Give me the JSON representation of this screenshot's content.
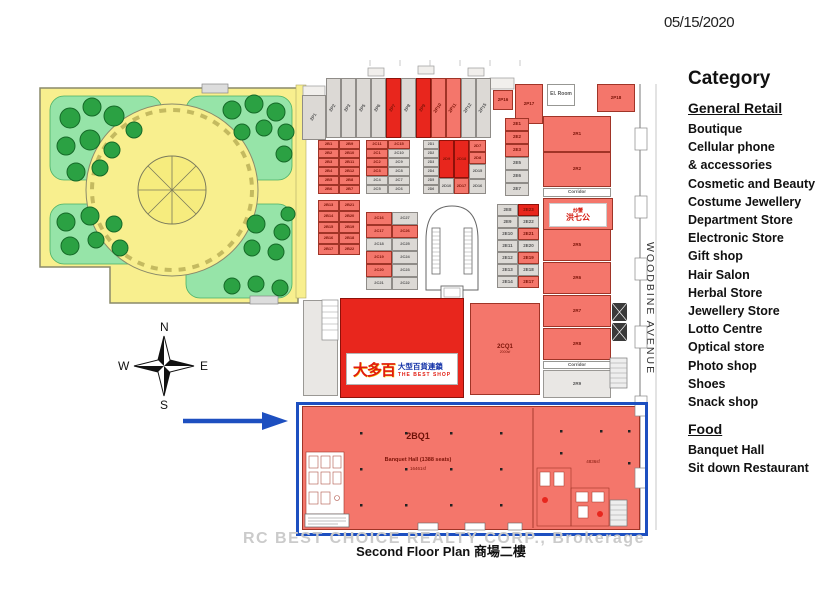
{
  "date": "05/15/2020",
  "street": "WOODBINE AVENUE",
  "caption": {
    "watermark": "RC BEST CHOICE REALTY CORP., Brokerage",
    "title": "Second Floor Plan 商場二樓"
  },
  "legend": {
    "title": "Category",
    "sections": [
      {
        "heading": "General Retail",
        "items": [
          "Boutique",
          "Cellular phone",
          "& accessories",
          "Cosmetic and Beauty",
          "Costume Jewellery",
          "Department Store",
          "Electronic Store",
          "Gift shop",
          "Hair Salon",
          "Herbal Store",
          "Jewellery Store",
          "Lotto Centre",
          "Optical store",
          "Photo shop",
          "Shoes",
          "Snack shop"
        ]
      },
      {
        "heading": "Food",
        "items": [
          "Banquet Hall",
          "Sit down Restaurant"
        ]
      }
    ]
  },
  "plan": {
    "compass": {
      "n": "N",
      "e": "E",
      "s": "S",
      "w": "W"
    },
    "banquet": {
      "label": "2BQ1",
      "desc": "Banquet Hall (1388 seats)",
      "area": "16461sf",
      "area_right": "4836sf"
    },
    "shop": {
      "main": "大多百",
      "sub_cn": "大型百貨連鎖",
      "sub_en": "THE BEST SHOP"
    },
    "restaurant": {
      "line1": "炒蟹",
      "line2": "洪七公"
    },
    "units": [
      {
        "l": "2P1",
        "c": "g",
        "x": 302,
        "y": 95,
        "w": 24,
        "h": 45,
        "rot": 1
      },
      {
        "l": "2P2",
        "c": "g",
        "x": 326,
        "y": 78,
        "w": 15,
        "h": 60,
        "rot": 1
      },
      {
        "l": "2P3",
        "c": "g",
        "x": 341,
        "y": 78,
        "w": 15,
        "h": 60,
        "rot": 1
      },
      {
        "l": "2P5",
        "c": "g",
        "x": 356,
        "y": 78,
        "w": 15,
        "h": 60,
        "rot": 1
      },
      {
        "l": "2P6",
        "c": "g",
        "x": 371,
        "y": 78,
        "w": 15,
        "h": 60,
        "rot": 1
      },
      {
        "l": "2P7",
        "c": "R",
        "x": 386,
        "y": 78,
        "w": 15,
        "h": 60,
        "rot": 1
      },
      {
        "l": "2P8",
        "c": "g",
        "x": 401,
        "y": 78,
        "w": 15,
        "h": 60,
        "rot": 1
      },
      {
        "l": "2P9",
        "c": "R",
        "x": 416,
        "y": 78,
        "w": 15,
        "h": 60,
        "rot": 1
      },
      {
        "l": "2P10",
        "c": "r",
        "x": 431,
        "y": 78,
        "w": 15,
        "h": 60,
        "rot": 1
      },
      {
        "l": "2P11",
        "c": "r",
        "x": 446,
        "y": 78,
        "w": 15,
        "h": 60,
        "rot": 1
      },
      {
        "l": "2P12",
        "c": "g",
        "x": 461,
        "y": 78,
        "w": 15,
        "h": 60,
        "rot": 1
      },
      {
        "l": "2P15",
        "c": "g",
        "x": 476,
        "y": 78,
        "w": 15,
        "h": 60,
        "rot": 1
      },
      {
        "l": "2P16",
        "c": "r",
        "x": 493,
        "y": 90,
        "w": 20,
        "h": 20
      },
      {
        "l": "2P17",
        "c": "r",
        "x": 515,
        "y": 84,
        "w": 28,
        "h": 40
      },
      {
        "l": "El. Room",
        "c": "w",
        "x": 547,
        "y": 84,
        "w": 28,
        "h": 22,
        "f": 5
      },
      {
        "l": "2P18",
        "c": "r",
        "x": 597,
        "y": 84,
        "w": 38,
        "h": 28
      },
      {
        "l": "2R1",
        "c": "r",
        "x": 543,
        "y": 116,
        "w": 68,
        "h": 36
      },
      {
        "l": "2R2",
        "c": "r",
        "x": 543,
        "y": 152,
        "w": 68,
        "h": 35
      },
      {
        "l": "Corridor",
        "c": "w",
        "x": 543,
        "y": 188,
        "w": 68,
        "h": 9,
        "f": 4.5
      },
      {
        "l": "2R5",
        "c": "r",
        "x": 543,
        "y": 229,
        "w": 68,
        "h": 32
      },
      {
        "l": "2R6",
        "c": "r",
        "x": 543,
        "y": 262,
        "w": 68,
        "h": 32
      },
      {
        "l": "2R7",
        "c": "r",
        "x": 543,
        "y": 295,
        "w": 68,
        "h": 32
      },
      {
        "l": "2R8",
        "c": "r",
        "x": 543,
        "y": 328,
        "w": 68,
        "h": 32
      },
      {
        "l": "Corridor",
        "c": "w",
        "x": 543,
        "y": 361,
        "w": 68,
        "h": 8,
        "f": 4.5
      },
      {
        "l": "2R9",
        "c": "G",
        "x": 543,
        "y": 370,
        "w": 68,
        "h": 28
      },
      {
        "l": "2E1",
        "c": "r",
        "x": 505,
        "y": 118,
        "w": 24,
        "h": 13
      },
      {
        "l": "2E2",
        "c": "r",
        "x": 505,
        "y": 131,
        "w": 24,
        "h": 13
      },
      {
        "l": "2E3",
        "c": "r",
        "x": 505,
        "y": 144,
        "w": 24,
        "h": 13
      },
      {
        "l": "2E5",
        "c": "g",
        "x": 505,
        "y": 157,
        "w": 24,
        "h": 13
      },
      {
        "l": "2E6",
        "c": "g",
        "x": 505,
        "y": 170,
        "w": 24,
        "h": 13
      },
      {
        "l": "2E7",
        "c": "g",
        "x": 505,
        "y": 183,
        "w": 24,
        "h": 13
      },
      {
        "l": "2E8",
        "c": "g",
        "x": 497,
        "y": 204,
        "w": 21,
        "h": 12
      },
      {
        "l": "2E23",
        "c": "R",
        "x": 518,
        "y": 204,
        "w": 21,
        "h": 12
      },
      {
        "l": "2E9",
        "c": "g",
        "x": 497,
        "y": 216,
        "w": 21,
        "h": 12
      },
      {
        "l": "2E22",
        "c": "g",
        "x": 518,
        "y": 216,
        "w": 21,
        "h": 12
      },
      {
        "l": "2E10",
        "c": "g",
        "x": 497,
        "y": 228,
        "w": 21,
        "h": 12
      },
      {
        "l": "2E21",
        "c": "r",
        "x": 518,
        "y": 228,
        "w": 21,
        "h": 12
      },
      {
        "l": "2E11",
        "c": "g",
        "x": 497,
        "y": 240,
        "w": 21,
        "h": 12
      },
      {
        "l": "2E20",
        "c": "g",
        "x": 518,
        "y": 240,
        "w": 21,
        "h": 12
      },
      {
        "l": "2E12",
        "c": "g",
        "x": 497,
        "y": 252,
        "w": 21,
        "h": 12
      },
      {
        "l": "2E19",
        "c": "r",
        "x": 518,
        "y": 252,
        "w": 21,
        "h": 12
      },
      {
        "l": "2E13",
        "c": "g",
        "x": 497,
        "y": 264,
        "w": 21,
        "h": 12
      },
      {
        "l": "2E18",
        "c": "g",
        "x": 518,
        "y": 264,
        "w": 21,
        "h": 12
      },
      {
        "l": "2E14",
        "c": "g",
        "x": 497,
        "y": 276,
        "w": 21,
        "h": 12
      },
      {
        "l": "2E17",
        "c": "r",
        "x": 518,
        "y": 276,
        "w": 21,
        "h": 12
      },
      {
        "l": "2B1",
        "c": "r",
        "x": 318,
        "y": 140,
        "w": 21,
        "h": 9,
        "f": 4
      },
      {
        "l": "2B9",
        "c": "r",
        "x": 339,
        "y": 140,
        "w": 21,
        "h": 9,
        "f": 4
      },
      {
        "l": "2B2",
        "c": "r",
        "x": 318,
        "y": 149,
        "w": 21,
        "h": 9,
        "f": 4
      },
      {
        "l": "2B10",
        "c": "r",
        "x": 339,
        "y": 149,
        "w": 21,
        "h": 9,
        "f": 4
      },
      {
        "l": "2B3",
        "c": "r",
        "x": 318,
        "y": 158,
        "w": 21,
        "h": 9,
        "f": 4
      },
      {
        "l": "2B11",
        "c": "r",
        "x": 339,
        "y": 158,
        "w": 21,
        "h": 9,
        "f": 4
      },
      {
        "l": "2B4",
        "c": "r",
        "x": 318,
        "y": 167,
        "w": 21,
        "h": 9,
        "f": 4
      },
      {
        "l": "2B12",
        "c": "r",
        "x": 339,
        "y": 167,
        "w": 21,
        "h": 9,
        "f": 4
      },
      {
        "l": "2B5",
        "c": "r",
        "x": 318,
        "y": 176,
        "w": 21,
        "h": 9,
        "f": 4
      },
      {
        "l": "2B8",
        "c": "r",
        "x": 339,
        "y": 176,
        "w": 21,
        "h": 9,
        "f": 4
      },
      {
        "l": "2B6",
        "c": "r",
        "x": 318,
        "y": 185,
        "w": 21,
        "h": 9,
        "f": 4
      },
      {
        "l": "2B7",
        "c": "r",
        "x": 339,
        "y": 185,
        "w": 21,
        "h": 9,
        "f": 4
      },
      {
        "l": "2C11",
        "c": "r",
        "x": 366,
        "y": 140,
        "w": 22,
        "h": 9,
        "f": 4
      },
      {
        "l": "2C15",
        "c": "r",
        "x": 388,
        "y": 140,
        "w": 22,
        "h": 9,
        "f": 4
      },
      {
        "l": "2C1",
        "c": "r",
        "x": 366,
        "y": 149,
        "w": 22,
        "h": 9,
        "f": 4
      },
      {
        "l": "2C10",
        "c": "g",
        "x": 388,
        "y": 149,
        "w": 22,
        "h": 9,
        "f": 4
      },
      {
        "l": "2C2",
        "c": "r",
        "x": 366,
        "y": 158,
        "w": 22,
        "h": 9,
        "f": 4
      },
      {
        "l": "2C9",
        "c": "g",
        "x": 388,
        "y": 158,
        "w": 22,
        "h": 9,
        "f": 4
      },
      {
        "l": "2C3",
        "c": "r",
        "x": 366,
        "y": 167,
        "w": 22,
        "h": 9,
        "f": 4
      },
      {
        "l": "2C8",
        "c": "g",
        "x": 388,
        "y": 167,
        "w": 22,
        "h": 9,
        "f": 4
      },
      {
        "l": "2C4",
        "c": "g",
        "x": 366,
        "y": 176,
        "w": 22,
        "h": 9,
        "f": 4
      },
      {
        "l": "2C7",
        "c": "g",
        "x": 388,
        "y": 176,
        "w": 22,
        "h": 9,
        "f": 4
      },
      {
        "l": "2C5",
        "c": "g",
        "x": 366,
        "y": 185,
        "w": 22,
        "h": 9,
        "f": 4
      },
      {
        "l": "2C6",
        "c": "g",
        "x": 388,
        "y": 185,
        "w": 22,
        "h": 9,
        "f": 4
      },
      {
        "l": "2B13",
        "c": "r",
        "x": 318,
        "y": 200,
        "w": 21,
        "h": 11,
        "f": 4
      },
      {
        "l": "2B21",
        "c": "r",
        "x": 339,
        "y": 200,
        "w": 21,
        "h": 11,
        "f": 4
      },
      {
        "l": "2B14",
        "c": "r",
        "x": 318,
        "y": 211,
        "w": 21,
        "h": 11,
        "f": 4
      },
      {
        "l": "2B20",
        "c": "r",
        "x": 339,
        "y": 211,
        "w": 21,
        "h": 11,
        "f": 4
      },
      {
        "l": "2B15",
        "c": "r",
        "x": 318,
        "y": 222,
        "w": 21,
        "h": 11,
        "f": 4
      },
      {
        "l": "2B19",
        "c": "r",
        "x": 339,
        "y": 222,
        "w": 21,
        "h": 11,
        "f": 4
      },
      {
        "l": "2B16",
        "c": "r",
        "x": 318,
        "y": 233,
        "w": 21,
        "h": 11,
        "f": 4
      },
      {
        "l": "2B18",
        "c": "r",
        "x": 339,
        "y": 233,
        "w": 21,
        "h": 11,
        "f": 4
      },
      {
        "l": "2B17",
        "c": "r",
        "x": 318,
        "y": 244,
        "w": 21,
        "h": 11,
        "f": 4
      },
      {
        "l": "2B22",
        "c": "r",
        "x": 339,
        "y": 244,
        "w": 21,
        "h": 11,
        "f": 4
      },
      {
        "l": "2C16",
        "c": "r",
        "x": 366,
        "y": 212,
        "w": 26,
        "h": 13,
        "f": 4
      },
      {
        "l": "2C27",
        "c": "g",
        "x": 392,
        "y": 212,
        "w": 26,
        "h": 13,
        "f": 4
      },
      {
        "l": "2C17",
        "c": "r",
        "x": 366,
        "y": 225,
        "w": 26,
        "h": 13,
        "f": 4
      },
      {
        "l": "2C26",
        "c": "r",
        "x": 392,
        "y": 225,
        "w": 26,
        "h": 13,
        "f": 4
      },
      {
        "l": "2C18",
        "c": "g",
        "x": 366,
        "y": 238,
        "w": 26,
        "h": 13,
        "f": 4
      },
      {
        "l": "2C25",
        "c": "g",
        "x": 392,
        "y": 238,
        "w": 26,
        "h": 13,
        "f": 4
      },
      {
        "l": "2C19",
        "c": "r",
        "x": 366,
        "y": 251,
        "w": 26,
        "h": 13,
        "f": 4
      },
      {
        "l": "2C24",
        "c": "g",
        "x": 392,
        "y": 251,
        "w": 26,
        "h": 13,
        "f": 4
      },
      {
        "l": "2C20",
        "c": "r",
        "x": 366,
        "y": 264,
        "w": 26,
        "h": 13,
        "f": 4
      },
      {
        "l": "2C23",
        "c": "g",
        "x": 392,
        "y": 264,
        "w": 26,
        "h": 13,
        "f": 4
      },
      {
        "l": "2C21",
        "c": "g",
        "x": 366,
        "y": 277,
        "w": 26,
        "h": 13,
        "f": 4
      },
      {
        "l": "2C22",
        "c": "g",
        "x": 392,
        "y": 277,
        "w": 26,
        "h": 13,
        "f": 4
      },
      {
        "l": "2D1",
        "c": "g",
        "x": 423,
        "y": 140,
        "w": 16,
        "h": 9,
        "f": 3.5
      },
      {
        "l": "2D2",
        "c": "g",
        "x": 423,
        "y": 149,
        "w": 16,
        "h": 9,
        "f": 3.5
      },
      {
        "l": "2D3",
        "c": "g",
        "x": 423,
        "y": 158,
        "w": 16,
        "h": 9,
        "f": 3.5
      },
      {
        "l": "2D4",
        "c": "g",
        "x": 423,
        "y": 167,
        "w": 16,
        "h": 9,
        "f": 3.5
      },
      {
        "l": "2D5",
        "c": "g",
        "x": 423,
        "y": 176,
        "w": 16,
        "h": 9,
        "f": 3.5
      },
      {
        "l": "2D6",
        "c": "g",
        "x": 423,
        "y": 185,
        "w": 16,
        "h": 9,
        "f": 3.5
      },
      {
        "l": "2D9",
        "c": "R",
        "x": 439,
        "y": 140,
        "w": 15,
        "h": 38,
        "f": 4
      },
      {
        "l": "2D10",
        "c": "g",
        "x": 439,
        "y": 178,
        "w": 15,
        "h": 16,
        "f": 4
      },
      {
        "l": "2D18",
        "c": "R",
        "x": 454,
        "y": 140,
        "w": 15,
        "h": 38,
        "f": 4
      },
      {
        "l": "2D17",
        "c": "r",
        "x": 454,
        "y": 178,
        "w": 15,
        "h": 16,
        "f": 4
      },
      {
        "l": "2D7",
        "c": "r",
        "x": 469,
        "y": 140,
        "w": 17,
        "h": 12,
        "f": 4
      },
      {
        "l": "2D8",
        "c": "r",
        "x": 469,
        "y": 152,
        "w": 17,
        "h": 12,
        "f": 4
      },
      {
        "l": "2D15",
        "c": "g",
        "x": 469,
        "y": 164,
        "w": 17,
        "h": 15,
        "f": 4
      },
      {
        "l": "2D16",
        "c": "g",
        "x": 469,
        "y": 179,
        "w": 17,
        "h": 15,
        "f": 4
      },
      {
        "l": "2CQ1",
        "a": "2000sf",
        "c": "r",
        "x": 470,
        "y": 303,
        "w": 70,
        "h": 92,
        "f": 6
      },
      {
        "l": "",
        "c": "G",
        "x": 303,
        "y": 300,
        "w": 35,
        "h": 96
      }
    ]
  }
}
